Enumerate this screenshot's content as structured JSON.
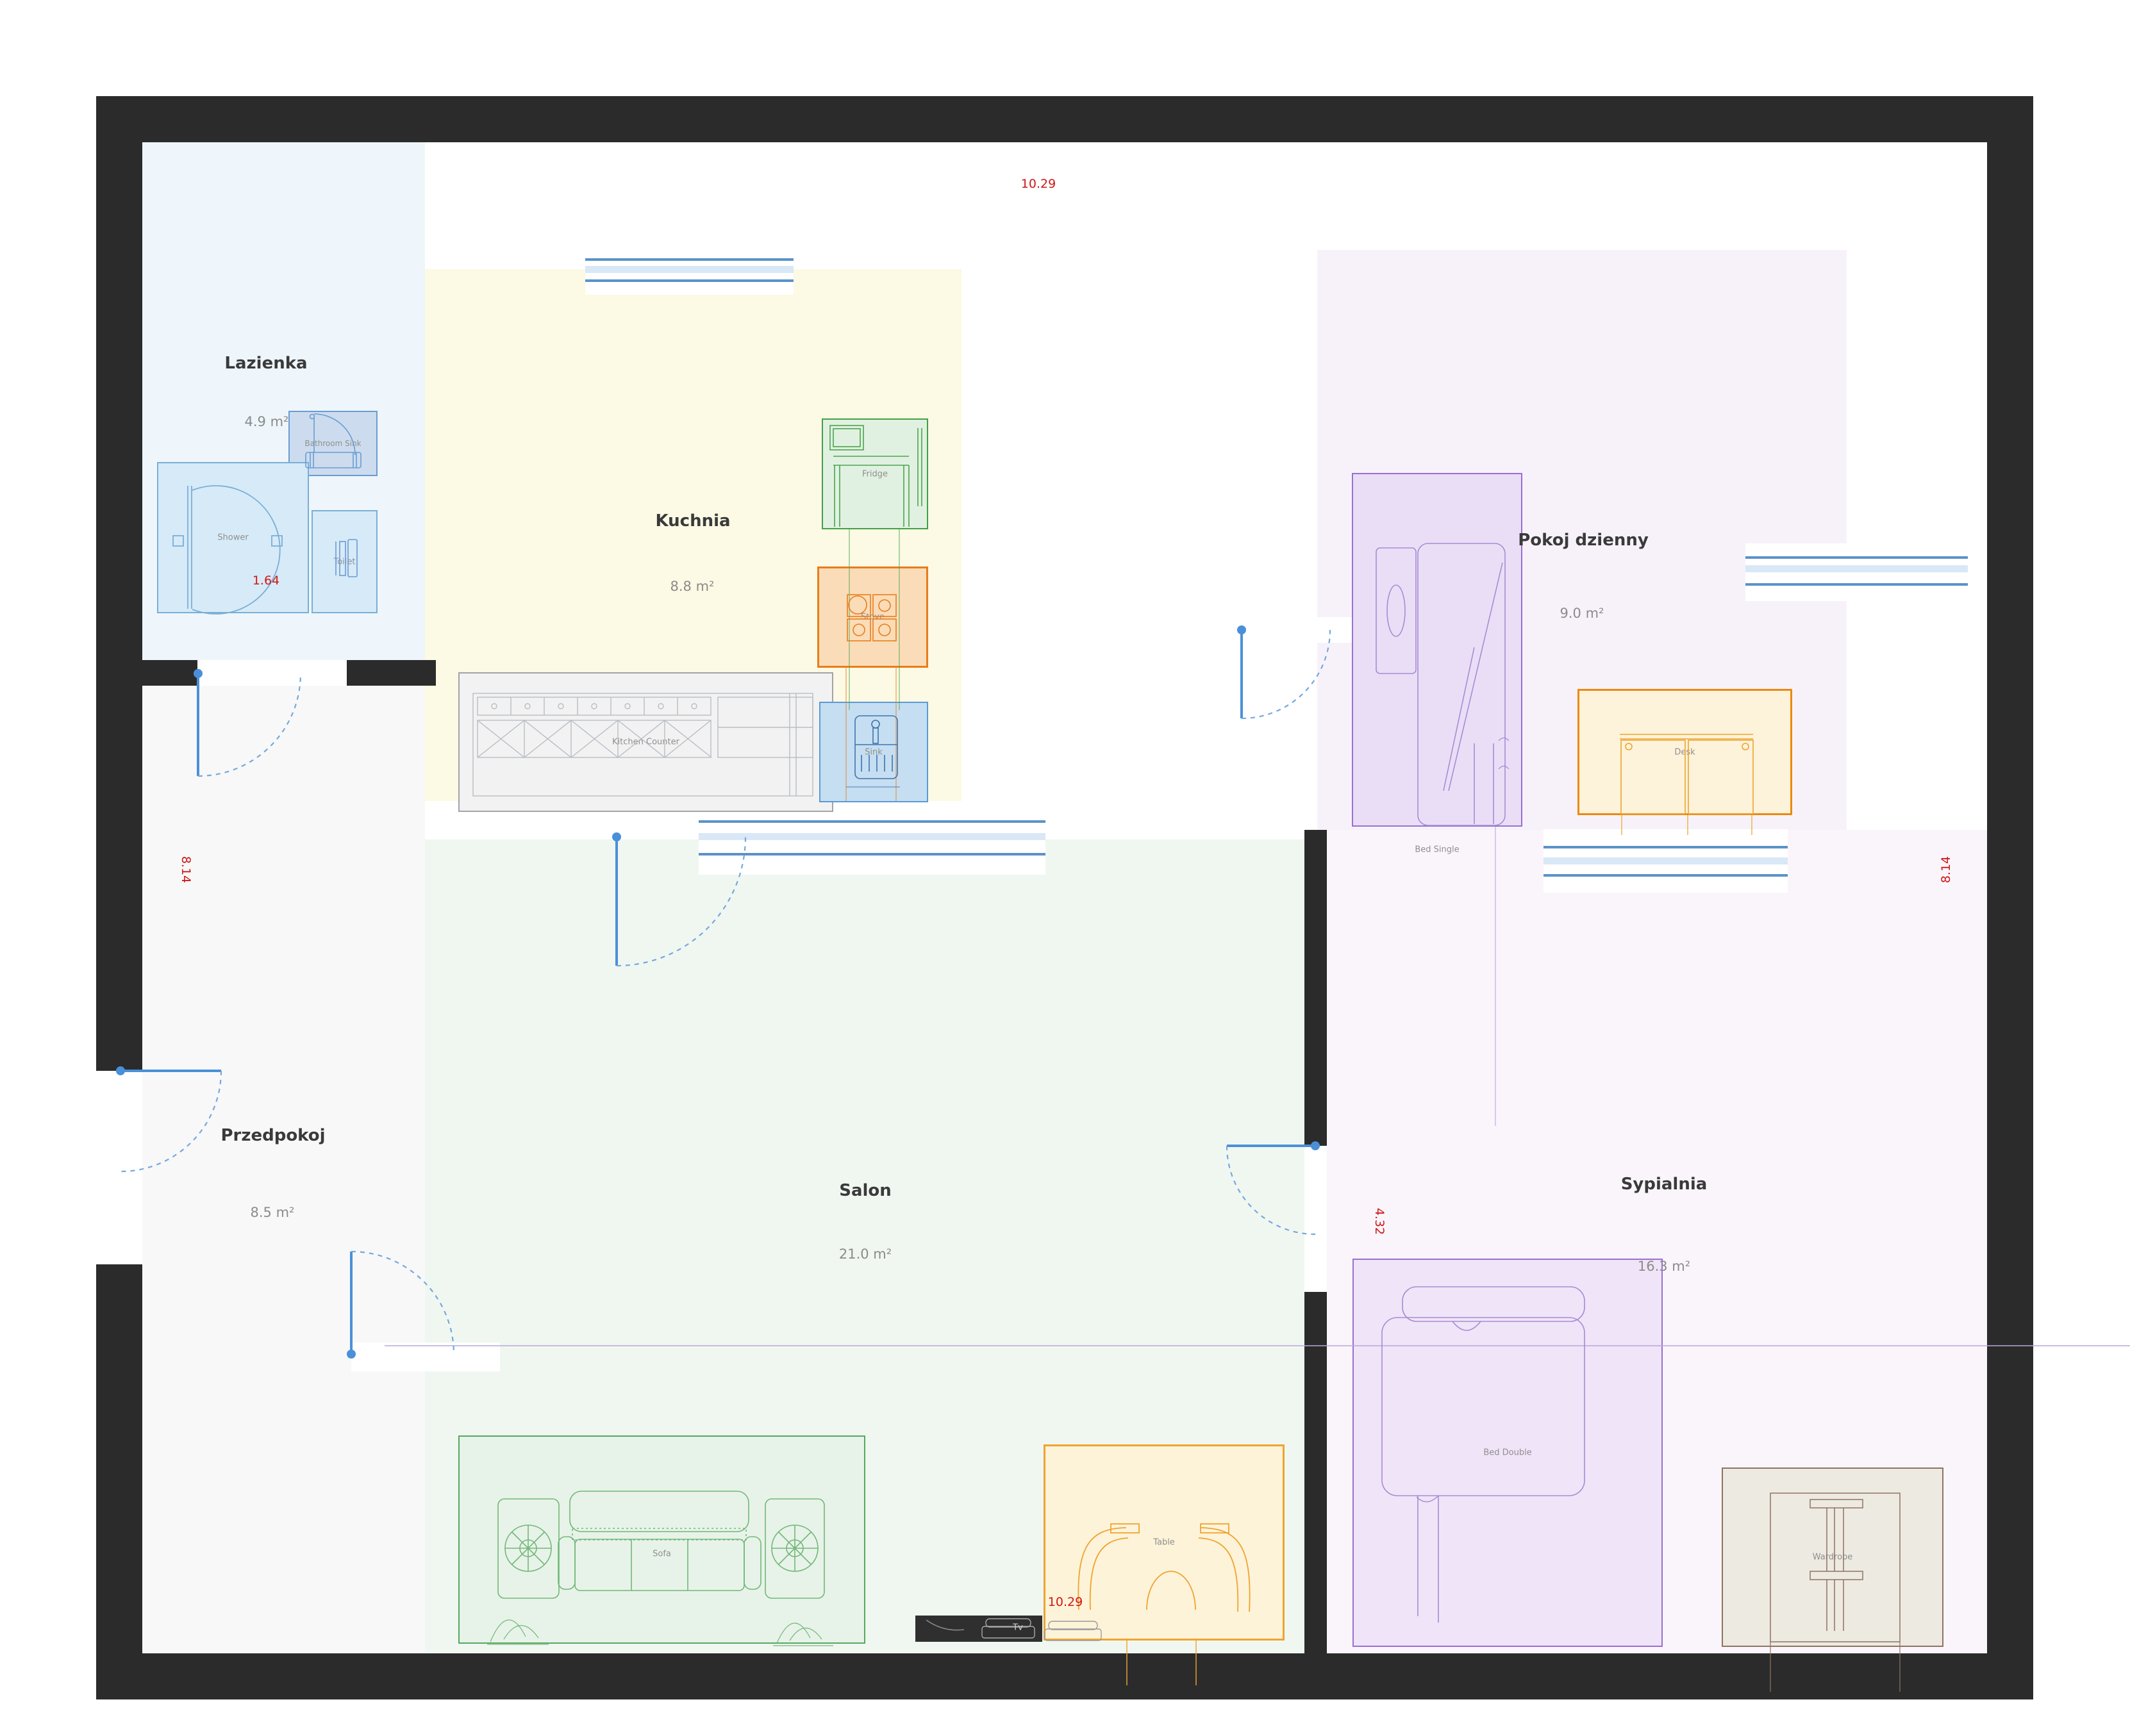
{
  "rooms": [
    {
      "name": "Lazienka",
      "area": "4.9 m²"
    },
    {
      "name": "Kuchnia",
      "area": "8.8 m²"
    },
    {
      "name": "Pokoj dzienny",
      "area": "9.0 m²"
    },
    {
      "name": "Przedpokoj",
      "area": "8.5 m²"
    },
    {
      "name": "Salon",
      "area": "21.0 m²"
    },
    {
      "name": "Sypialnia",
      "area": "16.3 m²"
    }
  ],
  "furniture": {
    "bathroom_sink": "Bathroom Sink",
    "shower": "Shower",
    "toilet": "Toilet",
    "fridge": "Fridge",
    "stove": "Stove",
    "kitchen_counter": "Kitchen Counter",
    "sink": "Sink",
    "bed_single": "Bed Single",
    "desk": "Desk",
    "sofa": "Sofa",
    "tv": "Tv",
    "table": "Table",
    "bed_double": "Bed Double",
    "wardrobe": "Wardrobe"
  },
  "dimensions": {
    "top_width": "10.29",
    "bottom_width": "10.29",
    "left_height": "8.14",
    "right_height": "8.14",
    "shower_width": "1.64",
    "sypialnia_height": "4.32"
  },
  "colors": {
    "wall": "#2b2b2b",
    "door": "#4a90d9",
    "window_frame": "#5b92c8",
    "window_glass": "#d9e8f6",
    "dimension_text": "#cf1717",
    "bathroom_accent": "#7aaed6",
    "fridge_green": "#43a047",
    "stove_orange": "#e87d1a",
    "sink_blue": "#5b9bd5",
    "sofa_green": "#57a85f",
    "table_orange": "#f0a330",
    "bed_purple": "#9a6fd0",
    "wardrobe_brown": "#8f7362"
  }
}
